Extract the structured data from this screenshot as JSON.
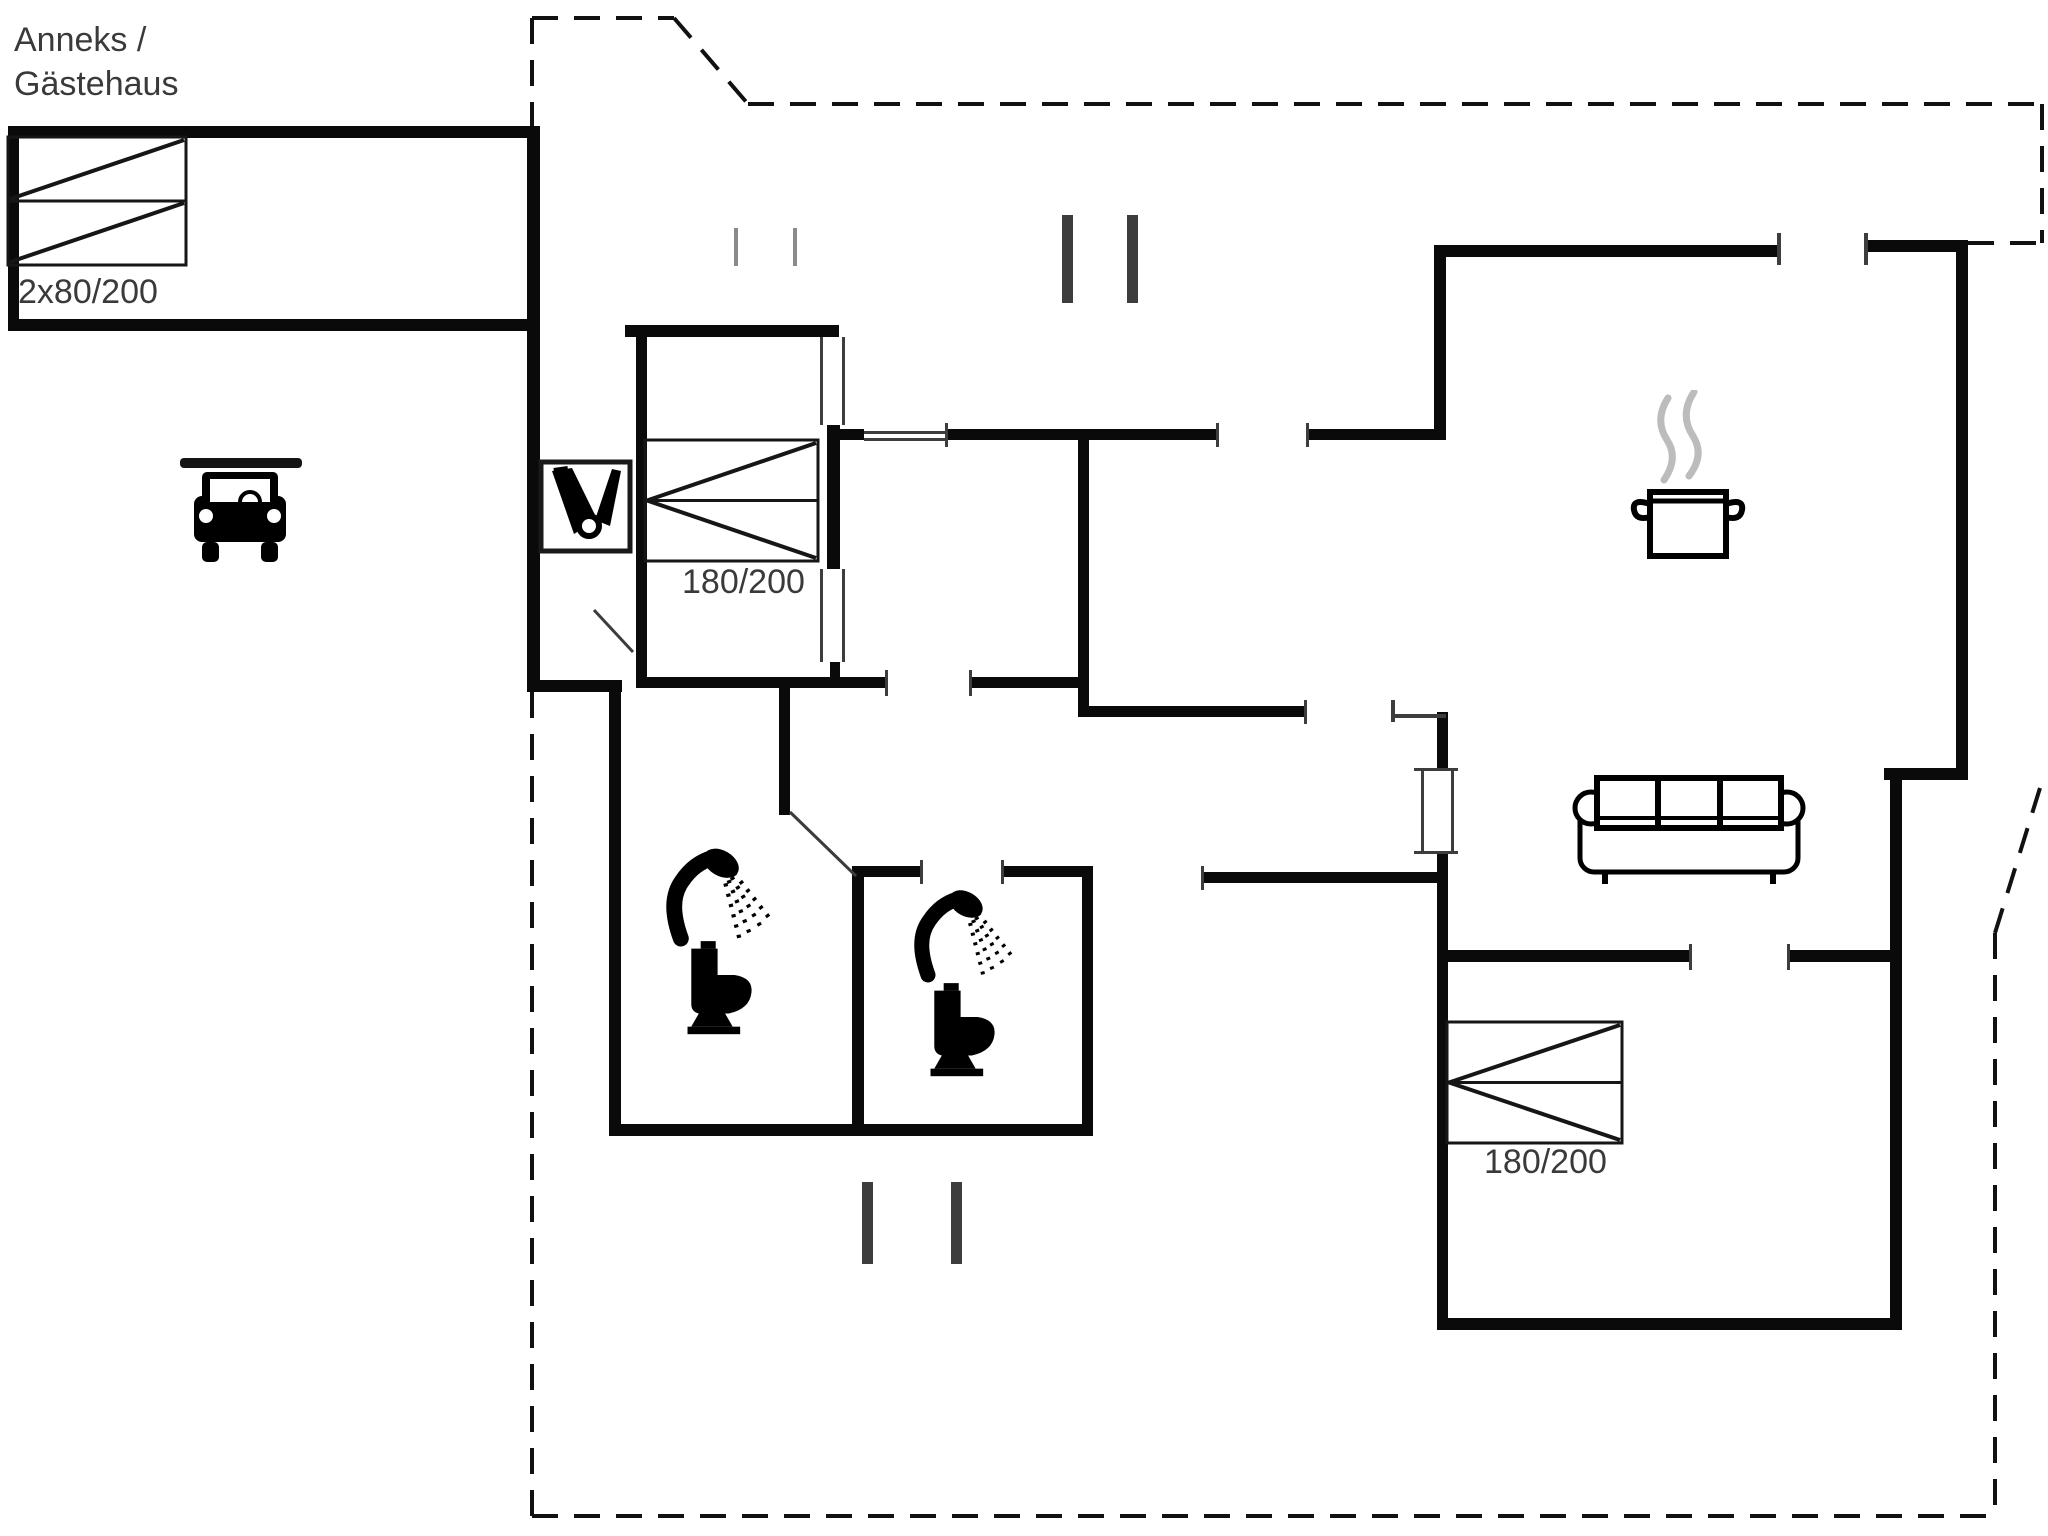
{
  "page": {
    "title": "Floor plan",
    "background": "#ffffff",
    "ink": "#0a0a0a",
    "label_color": "#3a3a3a",
    "steam_color": "#bcbcbc",
    "light_post_color": "#8a8a8a"
  },
  "labels": {
    "annex_line1": "Anneks /",
    "annex_line2": "Gästehaus",
    "annex_bed": "2x80/200",
    "bed1": "180/200",
    "bed2": "180/200"
  },
  "icons": [
    {
      "name": "car-icon",
      "meaning": "carport with parked car"
    },
    {
      "name": "cleaning-supplies-icon",
      "meaning": "utility / cleaning closet"
    },
    {
      "name": "shower-icon",
      "meaning": "shower head with spray (x2)"
    },
    {
      "name": "toilet-icon",
      "meaning": "toilet (x2)"
    },
    {
      "name": "cooking-pot-icon",
      "meaning": "kitchen - steaming pot"
    },
    {
      "name": "sofa-icon",
      "meaning": "three-seat sofa"
    },
    {
      "name": "bunk-beds-icon",
      "meaning": "two single beds 2x80/200"
    },
    {
      "name": "double-bed-icon",
      "meaning": "double bed 180/200 (x2)"
    }
  ],
  "floorplan": {
    "width": 2048,
    "height": 1536,
    "walls": [
      [
        8,
        126,
        532,
        12
      ],
      [
        8,
        126,
        11,
        205
      ],
      [
        8,
        319,
        532,
        12
      ],
      [
        527,
        126,
        13,
        566
      ],
      [
        527,
        680,
        95,
        12
      ],
      [
        609,
        680,
        12,
        456
      ],
      [
        609,
        1124,
        484,
        12
      ],
      [
        625,
        325,
        214,
        12
      ],
      [
        636,
        325,
        11,
        363
      ],
      [
        641,
        677,
        247,
        11
      ],
      [
        972,
        677,
        112,
        11
      ],
      [
        827,
        425,
        13,
        144
      ],
      [
        830,
        662,
        10,
        26
      ],
      [
        838,
        429,
        26,
        11
      ],
      [
        947,
        429,
        271,
        11
      ],
      [
        1308,
        429,
        138,
        11
      ],
      [
        1078,
        429,
        11,
        288
      ],
      [
        1078,
        706,
        228,
        11
      ],
      [
        779,
        688,
        11,
        127
      ],
      [
        852,
        872,
        12,
        258
      ],
      [
        852,
        866,
        70,
        11
      ],
      [
        1004,
        866,
        89,
        11
      ],
      [
        1082,
        866,
        11,
        264
      ],
      [
        1434,
        245,
        12,
        195
      ],
      [
        1434,
        245,
        346,
        12
      ],
      [
        1866,
        240,
        102,
        12
      ],
      [
        1956,
        240,
        12,
        540
      ],
      [
        1884,
        768,
        84,
        12
      ],
      [
        1890,
        768,
        12,
        562
      ],
      [
        1437,
        712,
        11,
        58
      ],
      [
        1437,
        853,
        11,
        477
      ],
      [
        1203,
        872,
        240,
        11
      ],
      [
        1437,
        950,
        255,
        12
      ],
      [
        1790,
        950,
        112,
        12
      ],
      [
        1437,
        1318,
        465,
        12
      ]
    ],
    "thin_lines": [
      {
        "x": 820,
        "y": 337,
        "w": 3,
        "h": 88
      },
      {
        "x": 842,
        "y": 337,
        "w": 3,
        "h": 88
      },
      {
        "x": 820,
        "y": 569,
        "w": 3,
        "h": 93
      },
      {
        "x": 842,
        "y": 569,
        "w": 3,
        "h": 93
      },
      {
        "x": 864,
        "y": 431,
        "w": 83,
        "h": 3
      },
      {
        "x": 864,
        "y": 438,
        "w": 83,
        "h": 3
      },
      {
        "x": 1421,
        "y": 770,
        "w": 3,
        "h": 83
      },
      {
        "x": 1451,
        "y": 770,
        "w": 3,
        "h": 83
      },
      {
        "x": 1414,
        "y": 768,
        "w": 44,
        "h": 3
      },
      {
        "x": 1414,
        "y": 851,
        "w": 44,
        "h": 3
      },
      {
        "x": 945,
        "y": 423,
        "w": 3,
        "h": 24
      },
      {
        "x": 1216,
        "y": 423,
        "w": 3,
        "h": 24
      },
      {
        "x": 1306,
        "y": 423,
        "w": 3,
        "h": 24
      },
      {
        "x": 885,
        "y": 670,
        "w": 3,
        "h": 26
      },
      {
        "x": 969,
        "y": 670,
        "w": 3,
        "h": 26
      },
      {
        "x": 920,
        "y": 860,
        "w": 3,
        "h": 24
      },
      {
        "x": 1001,
        "y": 860,
        "w": 3,
        "h": 24
      },
      {
        "x": 1304,
        "y": 700,
        "w": 3,
        "h": 24
      },
      {
        "x": 1391,
        "y": 700,
        "w": 4,
        "h": 22
      },
      {
        "x": 1391,
        "y": 714,
        "w": 55,
        "h": 4
      },
      {
        "x": 1689,
        "y": 944,
        "w": 3,
        "h": 26
      },
      {
        "x": 1787,
        "y": 944,
        "w": 3,
        "h": 26
      },
      {
        "x": 1201,
        "y": 866,
        "w": 3,
        "h": 24
      },
      {
        "x": 1777,
        "y": 233,
        "w": 4,
        "h": 32
      },
      {
        "x": 1864,
        "y": 233,
        "w": 4,
        "h": 32
      },
      {
        "x": 1062,
        "y": 215,
        "w": 11,
        "h": 88
      },
      {
        "x": 1127,
        "y": 215,
        "w": 11,
        "h": 88
      },
      {
        "x": 734,
        "y": 228,
        "w": 4,
        "h": 38,
        "c": "#8a8a8a"
      },
      {
        "x": 793,
        "y": 228,
        "w": 4,
        "h": 38,
        "c": "#8a8a8a"
      },
      {
        "x": 862,
        "y": 1182,
        "w": 11,
        "h": 82
      },
      {
        "x": 951,
        "y": 1182,
        "w": 11,
        "h": 82
      }
    ],
    "dashed_lines": [
      [
        532,
        18,
        674,
        18
      ],
      [
        674,
        18,
        748,
        104
      ],
      [
        748,
        104,
        2042,
        104
      ],
      [
        2042,
        104,
        2042,
        243
      ],
      [
        1968,
        243,
        2042,
        243
      ],
      [
        2040,
        788,
        1995,
        933
      ],
      [
        1995,
        933,
        1995,
        1516
      ],
      [
        532,
        1516,
        1995,
        1516
      ],
      [
        532,
        18,
        532,
        126
      ],
      [
        532,
        692,
        532,
        1516
      ]
    ],
    "door_swings": [
      [
        790,
        812,
        856,
        876
      ],
      [
        594,
        610,
        633,
        652
      ]
    ],
    "double_beds": [
      {
        "x": 645,
        "y": 440,
        "w": 173,
        "h": 121
      },
      {
        "x": 1447,
        "y": 1022,
        "w": 175,
        "h": 121
      }
    ],
    "bunk_bed": {
      "x": 8,
      "y": 137,
      "w": 178,
      "h": 128
    }
  }
}
